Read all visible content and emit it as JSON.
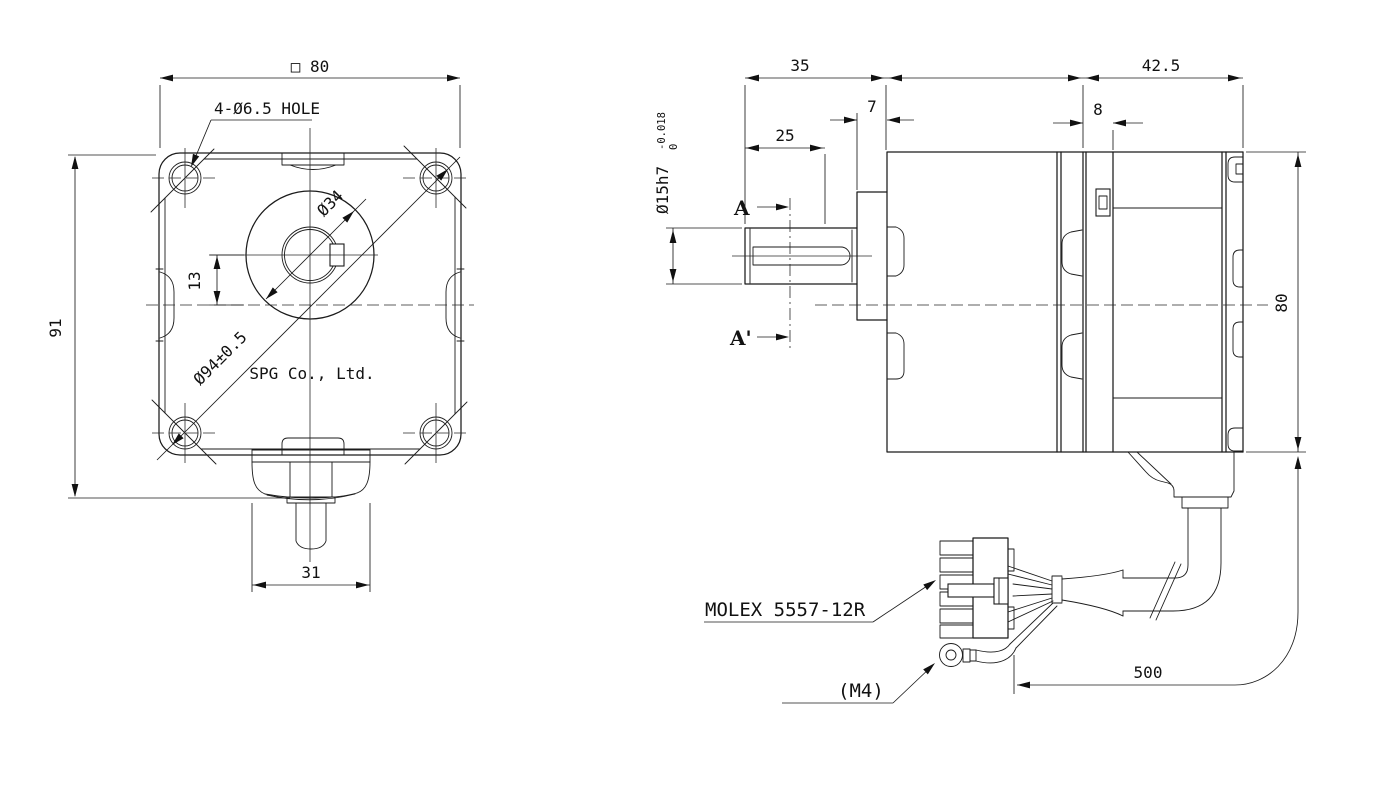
{
  "drawing": {
    "colors": {
      "line": "#1b1b1b",
      "background": "#ffffff"
    },
    "front": {
      "dim_square": "□ 80",
      "dim_height": "91",
      "dim_offset": "13",
      "dim_boss": "Ø34",
      "dim_bolt_circle": "Ø94±0.5",
      "dim_hub_width": "31",
      "holes_label": "4-Ø6.5 HOLE",
      "company": "SPG Co., Ltd."
    },
    "side": {
      "dim_shaft_len": "35",
      "dim_keyway_len": "25",
      "dim_boss_len": "7",
      "dim_ring_len": "8",
      "dim_motor_len": "42.5",
      "dim_height": "80",
      "dim_cable_len": "500",
      "shaft_dia": "Ø15h7",
      "shaft_tol_upper": "0",
      "shaft_tol_lower": "-0.018",
      "section_a": "A",
      "section_a_prime": "A'",
      "connector_label": "MOLEX 5557-12R",
      "terminal_label": "(M4)"
    }
  }
}
